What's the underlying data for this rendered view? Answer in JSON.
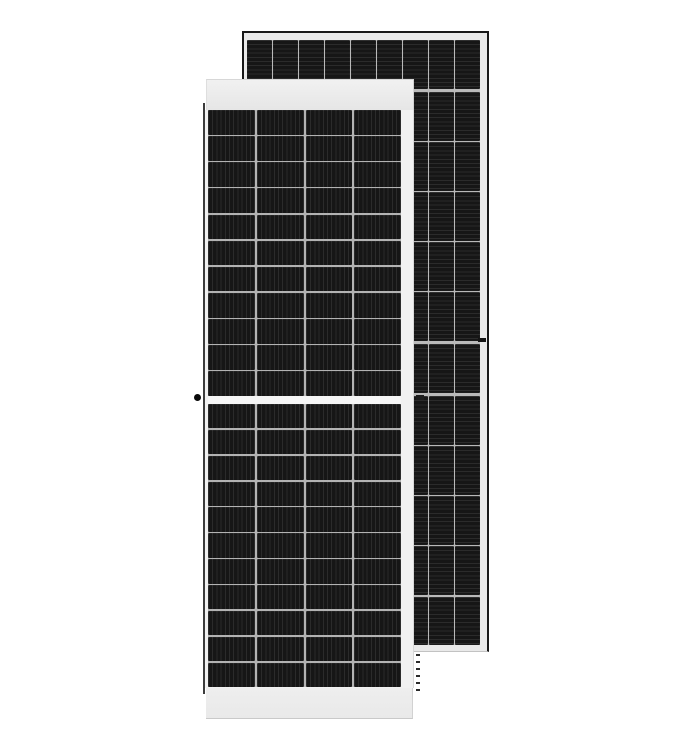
{
  "scene": {
    "type": "product-photo",
    "subject": "Two black half-cut-cell solar PV panels standing upright on a white background; a front portrait panel overlaps a taller rear panel",
    "background_color": "#ffffff"
  },
  "front_panel": {
    "description": "front solar panel, front face, white frame, center split",
    "cell_columns": 4,
    "cell_rows_top_half": 11,
    "cell_rows_bottom_half": 11,
    "stripe_direction": "vertical",
    "frame_color": "#f1f1f1",
    "frame_edge_color": "#c9c9c9",
    "left_edge_color": "#3c3c3c",
    "cell_color": "#161616",
    "cell_stripe_color": "#2b2b2b",
    "divider_color": "#b3b3b3",
    "center_gap_color": "#f5f5f5"
  },
  "back_panel": {
    "description": "rear solar panel, dark outlined light frame",
    "cell_columns": 9,
    "cell_rows": 12,
    "stripe_direction": "horizontal",
    "outline_color": "#181818",
    "frame_color": "#e9e9e9",
    "cell_color": "#161616",
    "cell_stripe_color": "#2b2b2b",
    "divider_color": "#b9b9b9",
    "thick_divider_after_rows": [
      1,
      6,
      7
    ]
  },
  "marks": {
    "grounding_dot_color": "#0a0a0a",
    "junction_dash_color": "#1c1c1c",
    "frame_hole_color": "#141414",
    "dotted_edge_color": "#2a2a2a"
  }
}
